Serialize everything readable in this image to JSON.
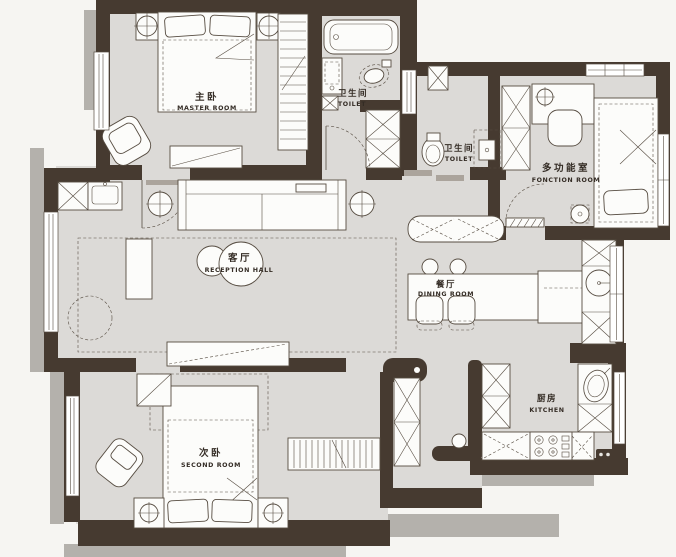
{
  "rooms": {
    "master": {
      "name_zh": "主卧",
      "name_en": "MASTER ROOM"
    },
    "bath_main": {
      "name_zh": "卫生间",
      "name_en": "TOILET"
    },
    "bath_hall": {
      "name_zh": "卫生间",
      "name_en": "TOILET"
    },
    "multi": {
      "name_zh": "多功能室",
      "name_en": "FONCTION ROOM"
    },
    "living": {
      "name_zh": "客厅",
      "name_en": "RECEPTION HALL"
    },
    "dining": {
      "name_zh": "餐厅",
      "name_en": "DINING ROOM"
    },
    "second": {
      "name_zh": "次卧",
      "name_en": "SECOND ROOM"
    },
    "kitchen": {
      "name_zh": "厨房",
      "name_en": "KITCHEN"
    }
  },
  "colors": {
    "wall": "#463a30",
    "floor": "#dcdad7",
    "shadow": "#b4b1ac",
    "furniture_line": "#564c41",
    "background": "#f6f5f2",
    "label_text": "#342c25"
  }
}
